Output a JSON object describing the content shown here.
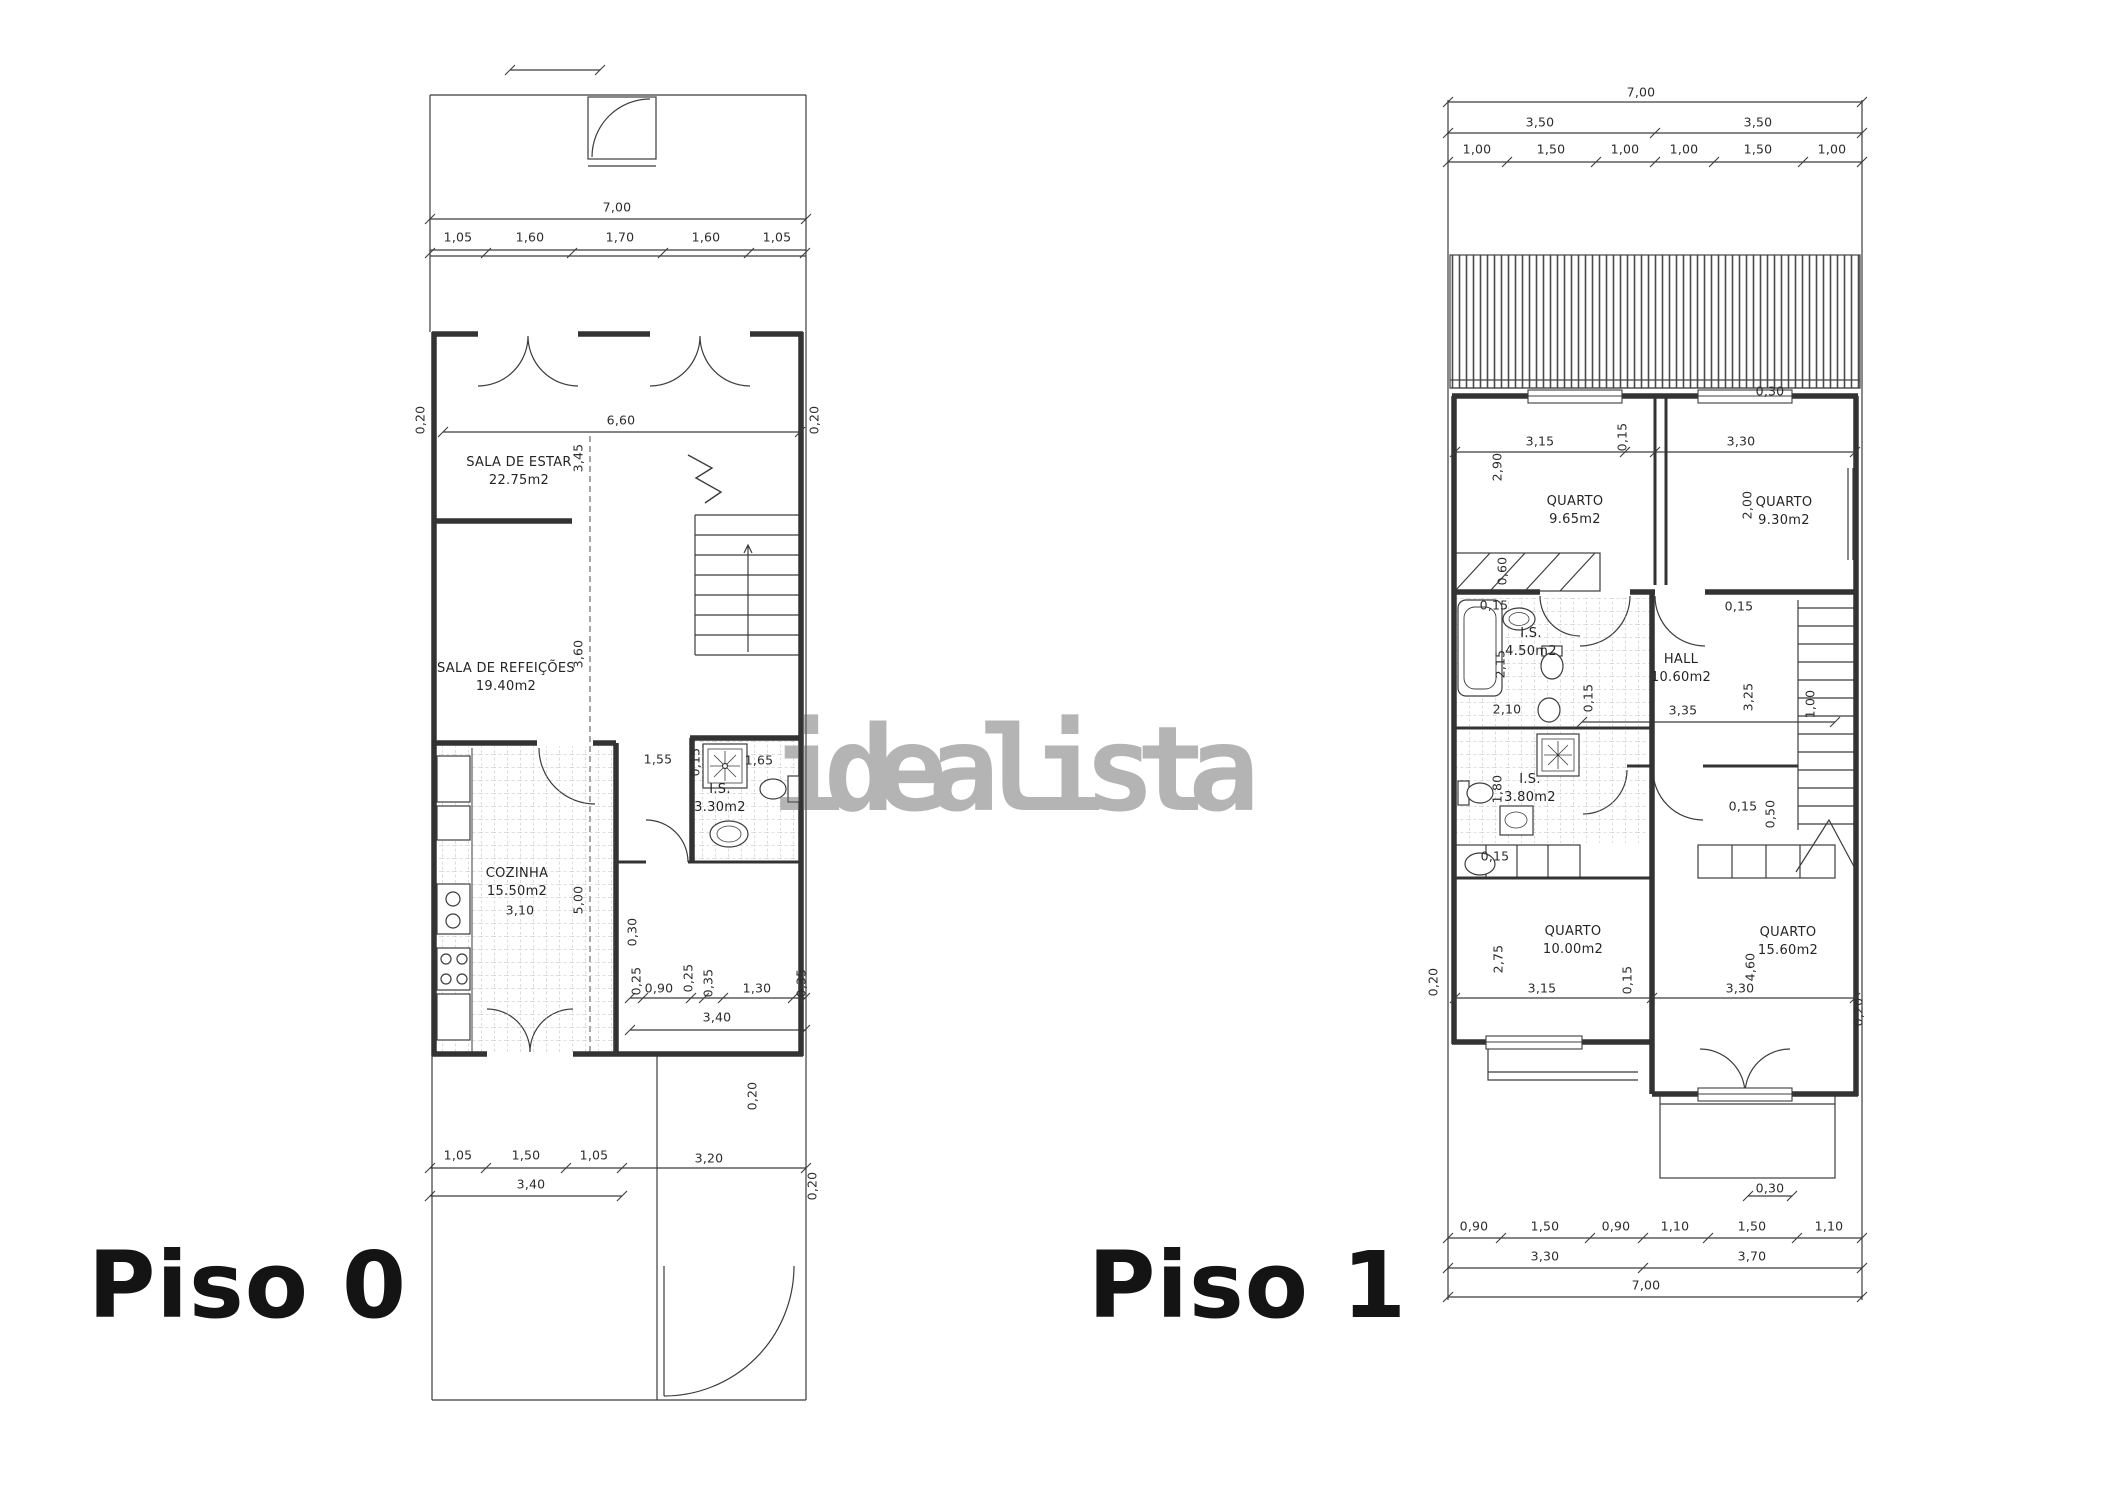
{
  "watermark": {
    "text": "idealista",
    "color": "#b4b4b4"
  },
  "colors": {
    "line": "#3c3c3c",
    "wall": "#333333",
    "text": "#2d2d2d",
    "background": "#ffffff"
  },
  "floor0": {
    "title": "Piso 0",
    "rooms": {
      "sala_estar": {
        "name": "SALA DE ESTAR",
        "area": "22.75m2"
      },
      "sala_refeicoes": {
        "name": "SALA DE REFEIÇÕES",
        "area": "19.40m2"
      },
      "cozinha": {
        "name": "COZINHA",
        "area": "15.50m2"
      },
      "is": {
        "name": "I.S.",
        "area": "3.30m2"
      }
    },
    "dims": {
      "width_total": "7,00",
      "top_segments": [
        "1,05",
        "1,60",
        "1,70",
        "1,60",
        "1,05"
      ],
      "interior_width": "6,60",
      "wall_left": "0,20",
      "wall_right": "0,20",
      "estar_depth": "3,45",
      "refeicoes_depth": "3,60",
      "pass_155": "1,55",
      "pass_015": "0,15",
      "pass_165": "1,65",
      "cozinha_width": "3,10",
      "cozinha_depth": "5,00",
      "wall_030": "0,30",
      "mid_segments": [
        "0,25",
        "0,90",
        "0,25",
        "0,35",
        "1,30",
        "0,35"
      ],
      "mid_total": "3,40",
      "wall_mid": "0,20",
      "bottom_segments": [
        "1,05",
        "1,50",
        "1,05"
      ],
      "bottom_total": "3,40",
      "bottom_right": "3,20",
      "wall_bottom": "0,20"
    }
  },
  "floor1": {
    "title": "Piso 1",
    "rooms": {
      "quarto_nw": {
        "name": "QUARTO",
        "area": "9.65m2"
      },
      "quarto_ne": {
        "name": "QUARTO",
        "area": "9.30m2"
      },
      "is_grande": {
        "name": "I.S.",
        "area": "4.50m2"
      },
      "hall": {
        "name": "HALL",
        "area": "10.60m2"
      },
      "is_pequena": {
        "name": "I.S.",
        "area": "3.80m2"
      },
      "quarto_sw": {
        "name": "QUARTO",
        "area": "10.00m2"
      },
      "quarto_se": {
        "name": "QUARTO",
        "area": "15.60m2"
      }
    },
    "dims": {
      "width_total_top": "7,00",
      "halves": [
        "3,50",
        "3,50"
      ],
      "top_segments": [
        "1,00",
        "1,50",
        "1,00",
        "1,00",
        "1,50",
        "1,00"
      ],
      "roof_step": "0,30",
      "quarto_nw_width": "3,15",
      "quarto_nw_depth": "2,90",
      "partition_quartos": "0,15",
      "quarto_ne_width": "3,30",
      "quarto_ne_depth": "2,00",
      "wardrobe_depth": "0,60",
      "is_grande_015": "0,15",
      "is_grande_depth": "2,15",
      "is_grande_width": "2,10",
      "hall_wall_015": "0,15",
      "hall_door_015": "0,15",
      "hall_width": "3,35",
      "hall_depth": "3,25",
      "stairs_width": "1,00",
      "is_pequena_depth": "1,80",
      "wardrobe_sw_015": "0,15",
      "window_se_015": "0,15",
      "window_se_050": "0,50",
      "quarto_sw_depth": "2,75",
      "quarto_sw_width": "3,15",
      "quarto_sw_wall": "0,15",
      "quarto_se_depth": "4,60",
      "quarto_se_width": "3,30",
      "wall_left": "0,20",
      "wall_right": "0,20",
      "balcony_step": "0,30",
      "bottom_segments": [
        "0,90",
        "1,50",
        "0,90",
        "1,10",
        "1,50",
        "1,10"
      ],
      "bottom_totals": [
        "3,30",
        "3,70"
      ],
      "width_total_bottom": "7,00"
    }
  }
}
